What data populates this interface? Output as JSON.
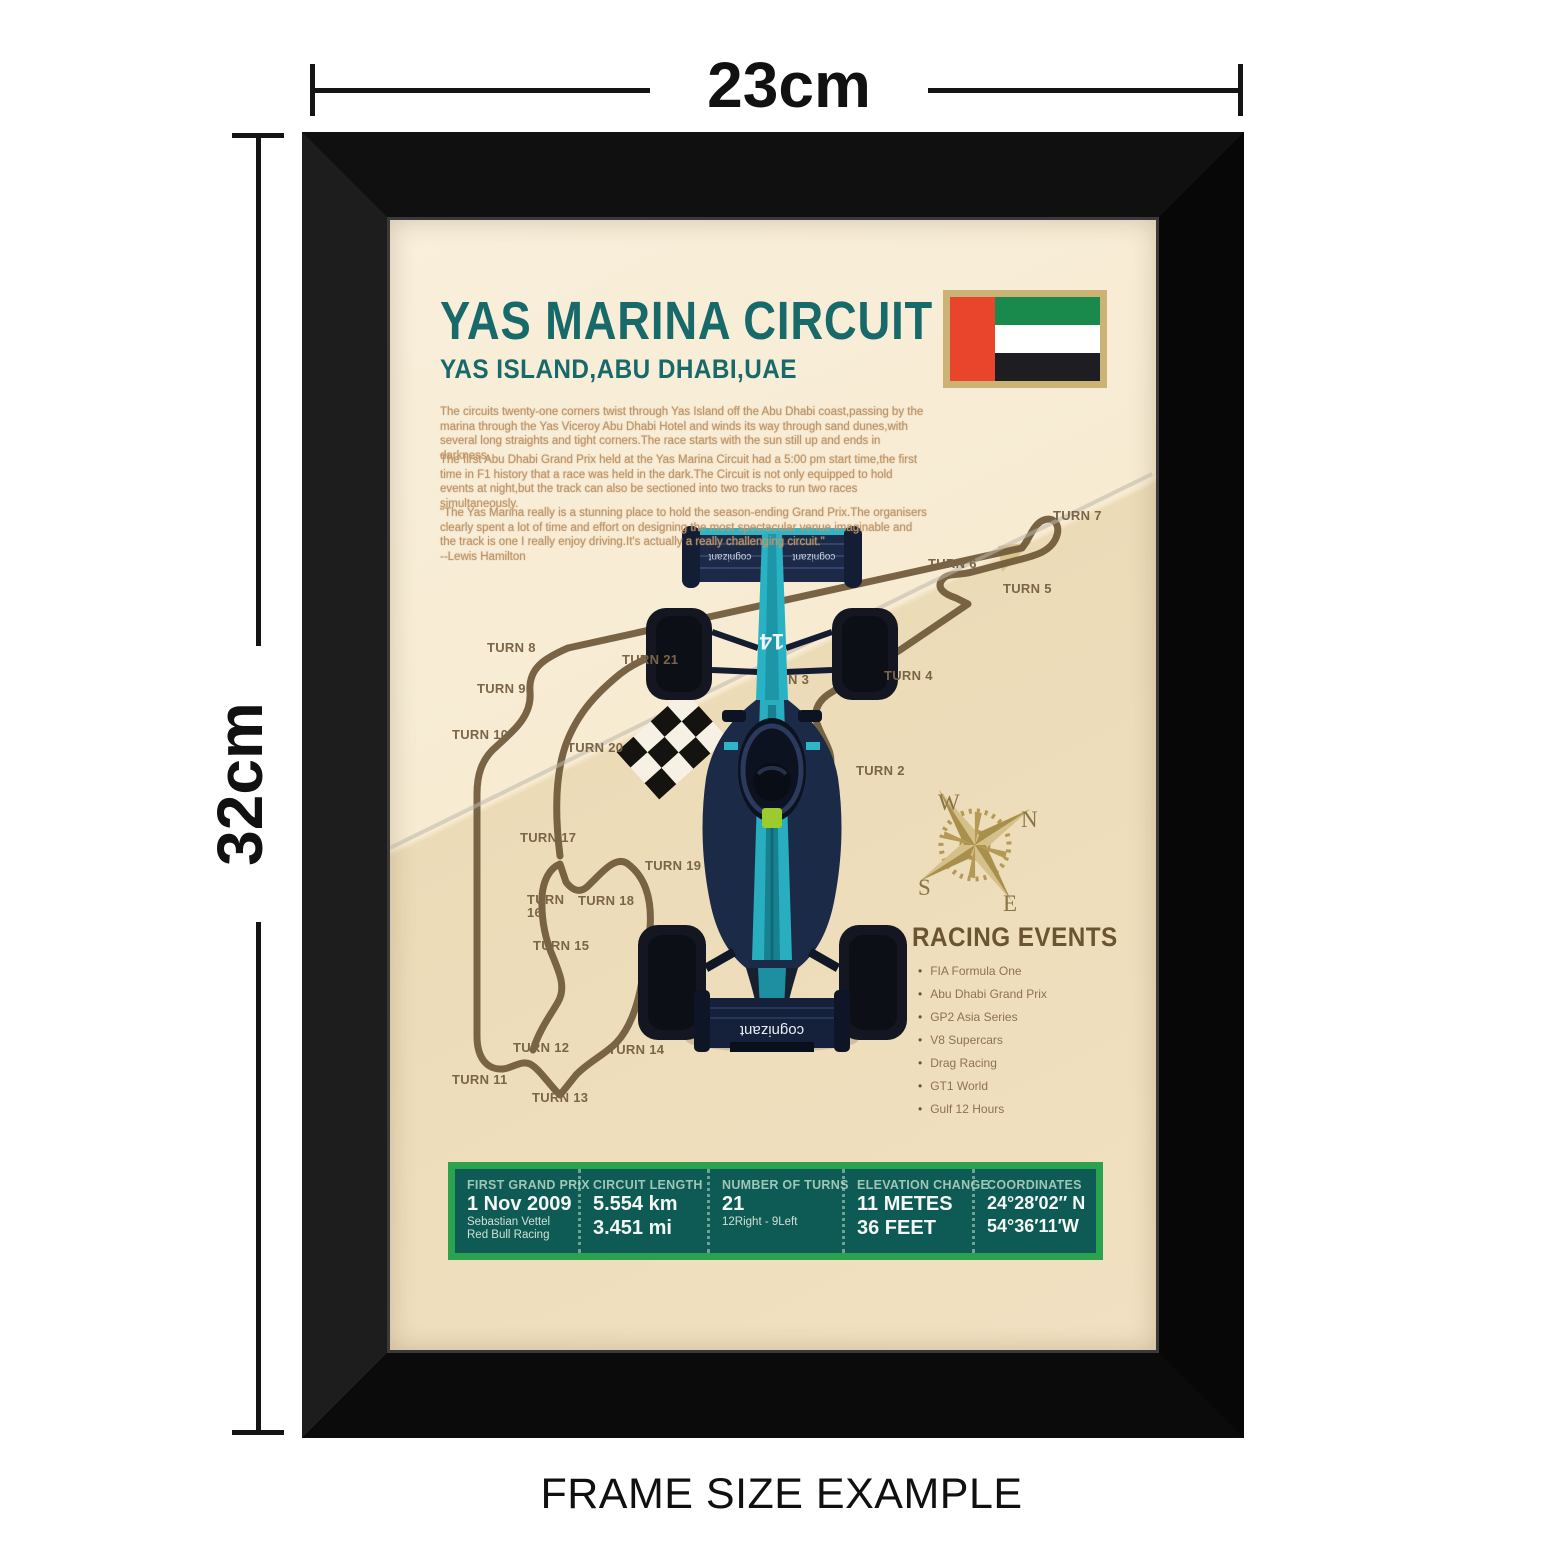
{
  "dimensions": {
    "width_label": "23cm",
    "height_label": "32cm"
  },
  "caption": "FRAME SIZE EXAMPLE",
  "poster": {
    "title": "YAS MARINA CIRCUIT",
    "subtitle": "YAS ISLAND,ABU DHABI,UAE",
    "paragraphs": [
      "The circuits twenty-one corners twist through Yas Island off the Abu Dhabi coast,passing by the marina through the Yas Viceroy Abu Dhabi Hotel and winds its way through sand dunes,with several long straights and tight corners.The race starts with the sun still up and ends in darkness.",
      "The first Abu Dhabi Grand Prix held at the Yas Marina Circuit had a 5:00 pm start time,the first time in F1 history that a race was held in the dark.The Circuit is not only equipped to hold events at night,but the track can also be sectioned into two tracks to run two races simultaneously.",
      "\"The Yas Marina really is a stunning place to hold the season-ending Grand Prix.The organisers clearly spent a lot of time and effort on designing the most spectacular venue imaginable and the track is one I really enjoy driving.It's actually a really challenging circuit.\"\n--Lewis Hamilton"
    ],
    "track": {
      "turns": [
        "TURN 7",
        "TURN 6",
        "TURN 5",
        "TURN 8",
        "TURN 21",
        "TURN 9",
        "N 3",
        "TURN 4",
        "TURN 10",
        "TURN 20",
        "TURN 2",
        "TURN 17",
        "TURN 19",
        "TURN 16",
        "TURN 18",
        "TURN 15",
        "TURN 12",
        "TURN 14",
        "TURN 11",
        "TURN 13"
      ]
    },
    "compass": {
      "n": "N",
      "e": "E",
      "s": "S",
      "w": "W"
    },
    "racing_events": {
      "heading": "RACING EVENTS",
      "items": [
        "FIA Formula One",
        "Abu Dhabi Grand Prix",
        "GP2 Asia Series",
        "V8 Supercars",
        "Drag Racing",
        "GT1 World",
        "Gulf 12 Hours"
      ]
    },
    "stats": {
      "columns": [
        {
          "label": "FIRST GRAND PRIX",
          "lines": [
            "1 Nov 2009",
            "Sebastian  Vettel",
            "Red Bull Racing"
          ]
        },
        {
          "label": "CIRCUIT LENGTH",
          "lines": [
            "5.554 km",
            "3.451 mi"
          ]
        },
        {
          "label": "NUMBER OF TURNS",
          "lines": [
            "21",
            "12Right - 9Left"
          ]
        },
        {
          "label": "ELEVATION CHANGE",
          "lines": [
            "11 METES",
            "36 FEET"
          ]
        },
        {
          "label": "COORDINATES",
          "lines": [
            "24°28′02″ N",
            "54°36′11′W"
          ]
        }
      ]
    }
  },
  "car": {
    "number": "14",
    "sponsor": "cognizant"
  },
  "colors": {
    "frame": "#111111",
    "poster_bg": "#f1e1c2",
    "title_teal": "#17696a",
    "track_brown": "#6e5939",
    "stats_green": "#2aa24e",
    "stats_teal": "#0e5a54",
    "car_teal": "#28aebe",
    "car_navy": "#1b2a47",
    "lime_accent": "#9ccb2e",
    "compass_gold": "#b59a55",
    "flag_red": "#e8452c",
    "flag_green": "#1a8a4c"
  }
}
